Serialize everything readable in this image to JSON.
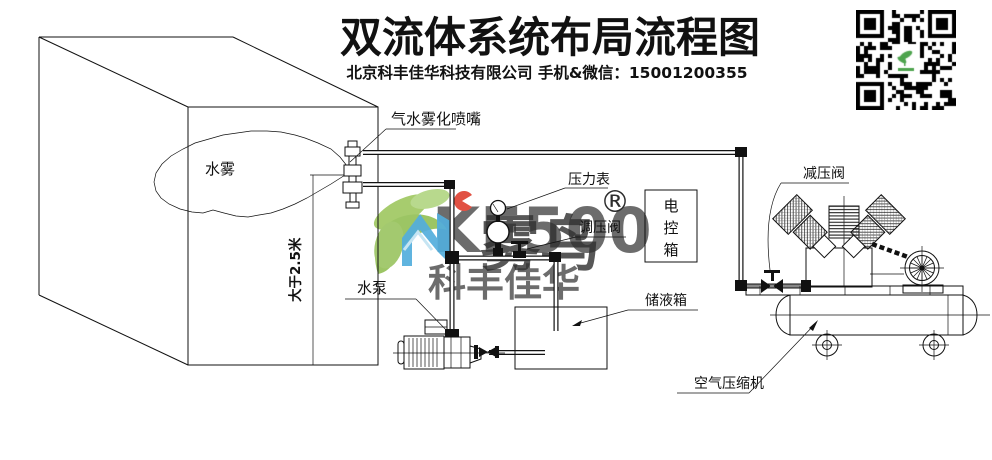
{
  "header": {
    "title": "双流体系统布局流程图",
    "subtitle": "北京科丰佳华科技有限公司 手机&微信：15001200355"
  },
  "qr": {
    "name": "wechat-qr-code"
  },
  "watermark": {
    "brand_en": "KF500",
    "brand_cn": "雾鸟",
    "registered_mark": "®",
    "company_short": "科丰佳华"
  },
  "diagram": {
    "mist_label": "水雾",
    "nozzle_label": "气水雾化喷嘴",
    "height_note": "大于2.5米",
    "pressure_gauge_label": "压力表",
    "regulating_valve_label": "调压阀",
    "control_box_chars": [
      "电",
      "控",
      "箱"
    ],
    "water_pump_label": "水泵",
    "storage_tank_label": "储液箱",
    "reducing_valve_label": "减压阀",
    "air_compressor_label": "空气压缩机"
  },
  "colors": {
    "line": "#111111",
    "watermark_green": "#97c25c",
    "watermark_blue": "#3ba3d8",
    "watermark_red": "#de3a2a",
    "watermark_gray": "#c4c4c4",
    "qr_green": "#4ea44e"
  }
}
